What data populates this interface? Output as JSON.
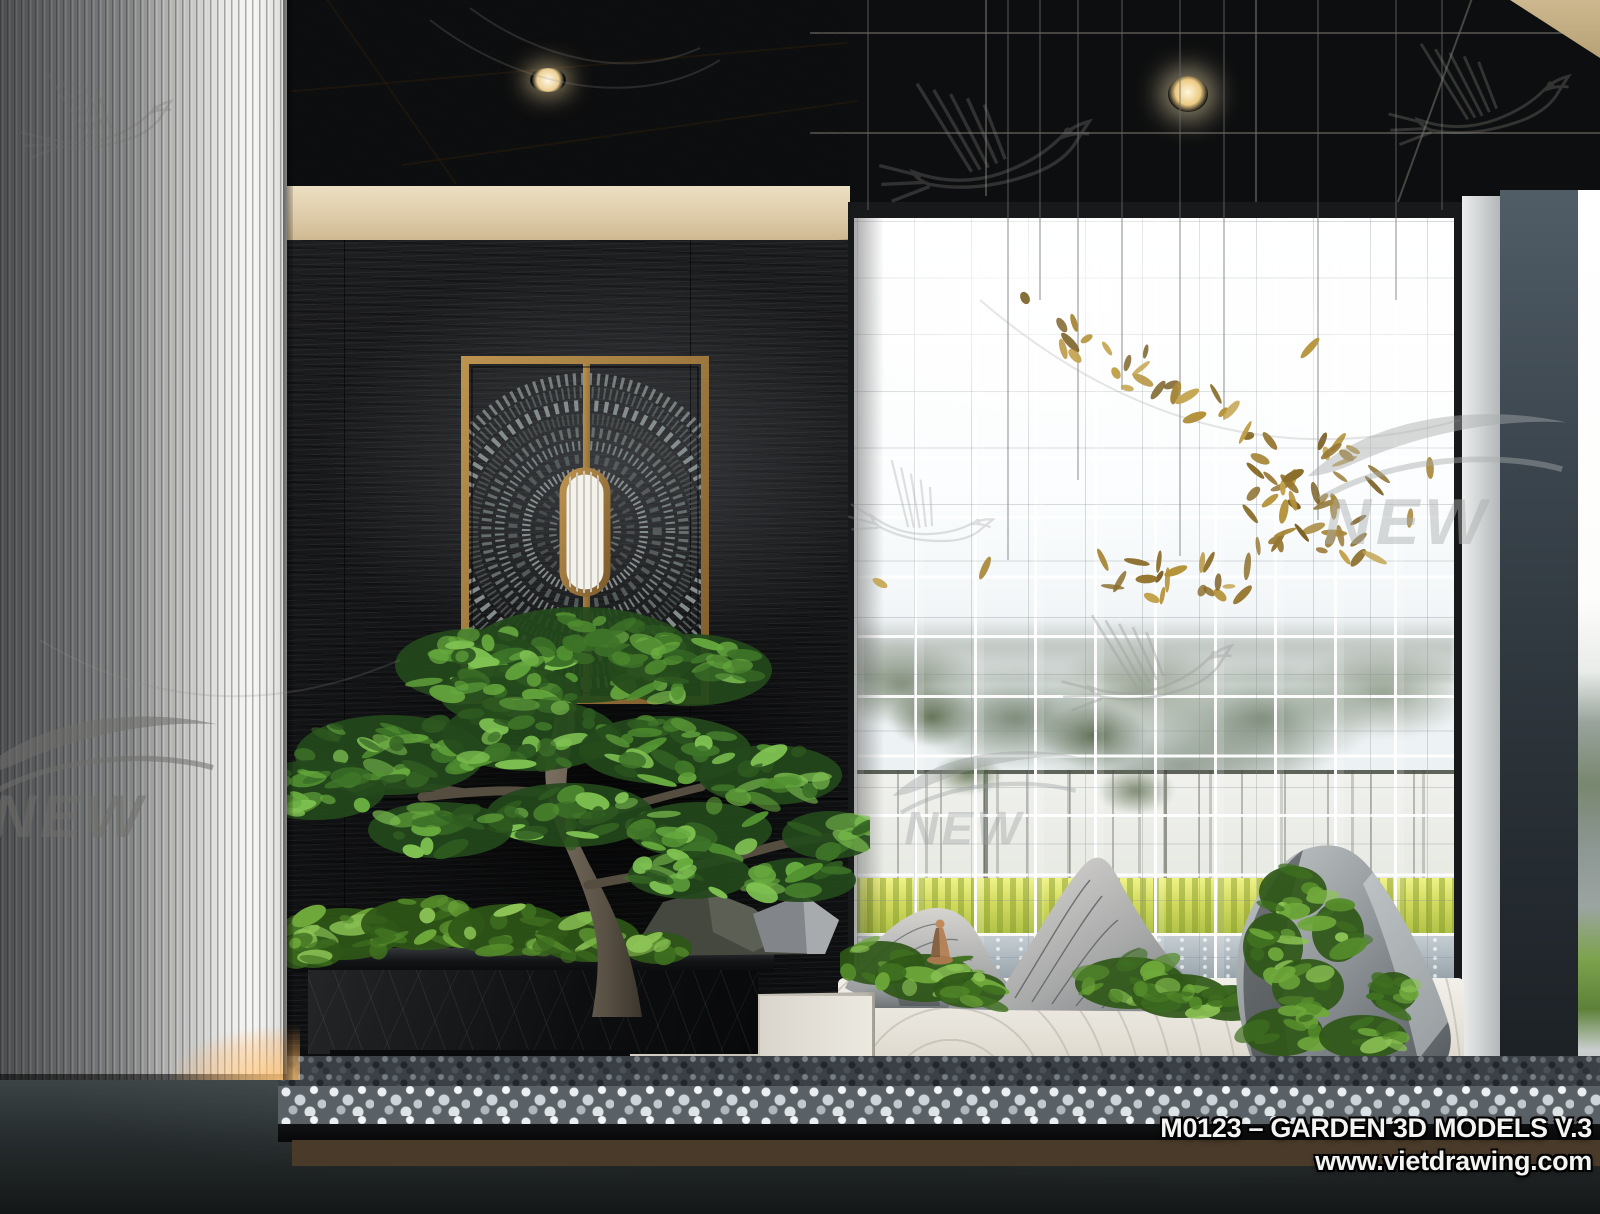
{
  "caption": {
    "line1": "M0123 – GARDEN 3D MODELS V.3",
    "line2": "www.vietdrawing.com"
  },
  "watermarks": {
    "logo_text": "NEW"
  },
  "palette": {
    "brass_frame": "#a57e3f",
    "wood_ceiling": "#8a6d42",
    "fascia_band": "#ddc9a4",
    "black_wall": "#17181a",
    "glass_block_white": "#f4f7f8",
    "moss_green": "#5a8a34",
    "bonsai_foliage": "#4f8230",
    "gold_leaves": "#a8883a",
    "sand": "#eae7e0",
    "planter_marble": "#141618",
    "white_pillar": "#ececea",
    "dark_pillar": "#39434b",
    "outside_grass": "#b5c648",
    "floor": "#23292b",
    "caption_text": "#f3f3f1"
  }
}
